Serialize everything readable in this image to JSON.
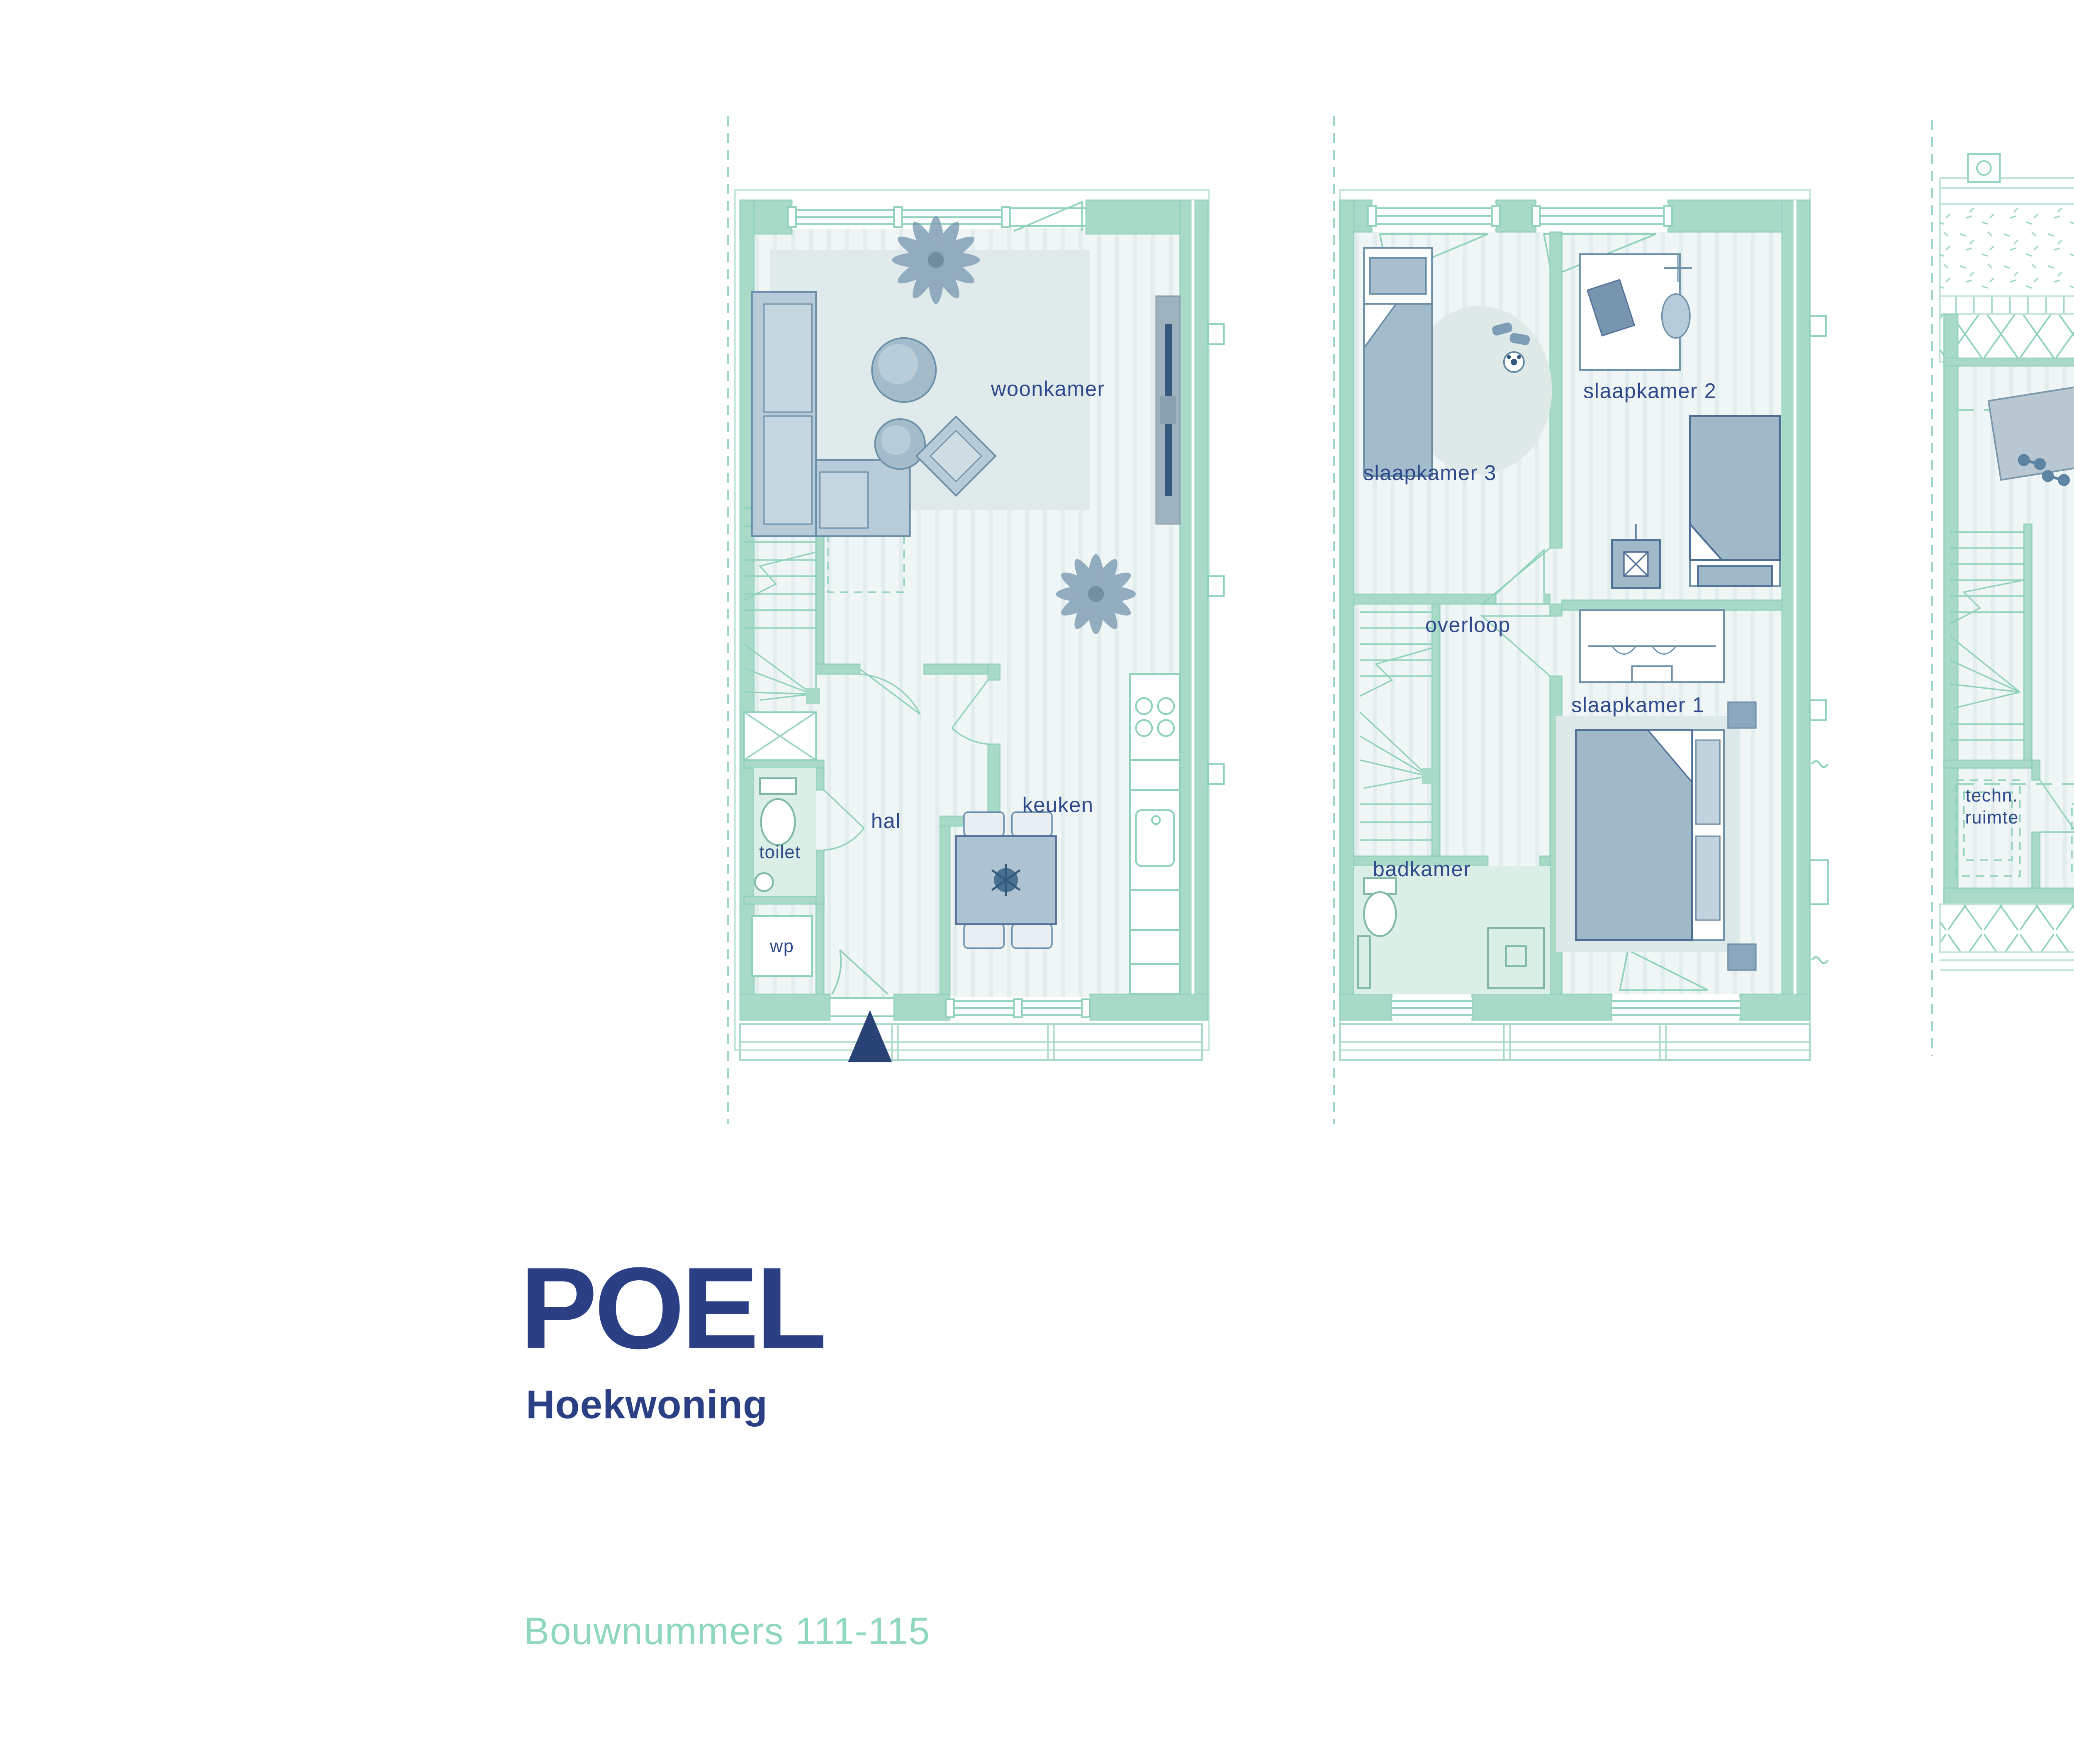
{
  "title_block": {
    "project": "POEL",
    "subtitle": "Hoekwoning",
    "bouwnummers": "Bouwnummers 111-115"
  },
  "logo": {
    "name": "SWANLA",
    "sub": "DRIEHOEK",
    "tagline": {
      "part1": "natuur",
      "part2": "inclusief",
      "part3": " wonen"
    }
  },
  "colors": {
    "wall_mint": "#a9dac8",
    "line_mint": "#8fd2bc",
    "label_navy": "#2e4a8c",
    "title_navy": "#2b3f85",
    "mint_text": "#8fd7bf",
    "logo_light_green": "#a5cd92",
    "logo_dark_green": "#1e4535",
    "logo_text_green": "#235042",
    "furniture_blue": "#b7cbd8",
    "arrow_navy": "#2a4377"
  },
  "plans": [
    {
      "id": "begane-grond",
      "rooms": [
        {
          "label": "woonkamer"
        },
        {
          "label": "hal"
        },
        {
          "label": "keuken"
        },
        {
          "label": "toilet"
        },
        {
          "label": "wp"
        }
      ]
    },
    {
      "id": "eerste-verdieping",
      "rooms": [
        {
          "label": "slaapkamer 2"
        },
        {
          "label": "slaapkamer 3"
        },
        {
          "label": "overloop"
        },
        {
          "label": "slaapkamer 1"
        },
        {
          "label": "badkamer"
        }
      ]
    },
    {
      "id": "tweede-verdieping",
      "rooms": [
        {
          "label": "zolder"
        },
        {
          "label": "techn. ruimte"
        }
      ]
    }
  ]
}
